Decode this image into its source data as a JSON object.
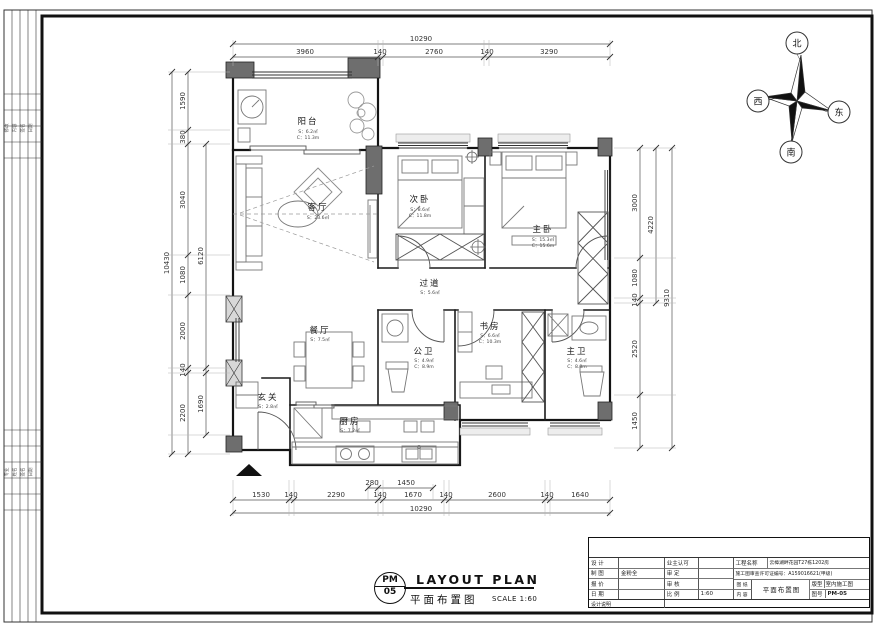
{
  "sheet": {
    "company": "广东星艺装饰集团有限公司",
    "titleblock": {
      "design_label": "设 计",
      "design_value": "",
      "draft_label": "制 图",
      "draft_value": "金粉全",
      "quote_label": "报 价",
      "quote_value": "",
      "date_label": "日 期",
      "date_value": "",
      "owner_label": "业主认可",
      "owner_value": "",
      "approve_label": "审 定",
      "approve_value": "",
      "check_label": "审 核",
      "check_value": "",
      "scale_label": "比 例",
      "scale_value": "1:60",
      "project_label": "工程名称",
      "project_value": "云樟湖畔花园T27栋1202房",
      "license": "施工图审查许可证编号：A159016621(甲级)",
      "sheet_label_1": "图 纸",
      "sheet_label_2": "内 容",
      "content_value": "平面布置图",
      "type_label": "版型",
      "type_value": "室内施工图",
      "no_label": "图号",
      "no_value": "PM-05",
      "note_label": "设计说明"
    },
    "footer": {
      "code_top": "PM",
      "code_bottom": "05",
      "title_en": "LAYOUT PLAN",
      "title_cn": "平面布置图",
      "scale": "SCALE 1:60"
    }
  },
  "compass": {
    "n": "北",
    "e": "东",
    "s": "南",
    "w": "西"
  },
  "rooms": [
    {
      "name": "阳台",
      "area": "S：6.2㎡",
      "perim": "C：11.3m"
    },
    {
      "name": "客厅",
      "area": "S：23.6㎡",
      "perim": ""
    },
    {
      "name": "次卧",
      "area": "S：8.6㎡",
      "perim": "C：11.8m"
    },
    {
      "name": "主卧",
      "area": "S：15.3㎡",
      "perim": "C：15.6m"
    },
    {
      "name": "过道",
      "area": "S：5.6㎡",
      "perim": ""
    },
    {
      "name": "餐厅",
      "area": "S：7.5㎡",
      "perim": ""
    },
    {
      "name": "书房",
      "area": "S：6.6㎡",
      "perim": "C：10.3m"
    },
    {
      "name": "公卫",
      "area": "S：4.9㎡",
      "perim": "C：8.9m"
    },
    {
      "name": "主卫",
      "area": "S：4.6㎡",
      "perim": "C：8.8m"
    },
    {
      "name": "玄关",
      "area": "S：2.8㎡",
      "perim": ""
    },
    {
      "name": "厨房",
      "area": "S：7.2㎡",
      "perim": ""
    }
  ],
  "dims": {
    "top": [
      "3960",
      "140",
      "2760",
      "140",
      "3290"
    ],
    "top_total": "10290",
    "bottom": [
      "1530",
      "140",
      "2290",
      "140",
      "1670",
      "140",
      "2600",
      "140",
      "1640"
    ],
    "bottom_total": "10290",
    "bottom_partial": [
      "280",
      "1450"
    ],
    "left": [
      "1590",
      "380",
      "3040",
      "1080",
      "2000",
      "140",
      "2200"
    ],
    "left_total": "10430",
    "left_inner": [
      "6120",
      "1690"
    ],
    "right": [
      "3000",
      "1080",
      "140",
      "2520",
      "1450"
    ],
    "right_inner": "4220",
    "right_total": "9310"
  },
  "strip": {
    "g1": [
      "修改",
      "内容",
      "签名",
      "日期"
    ],
    "g2": [
      "专业",
      "姓名",
      "签名",
      "日期"
    ]
  }
}
